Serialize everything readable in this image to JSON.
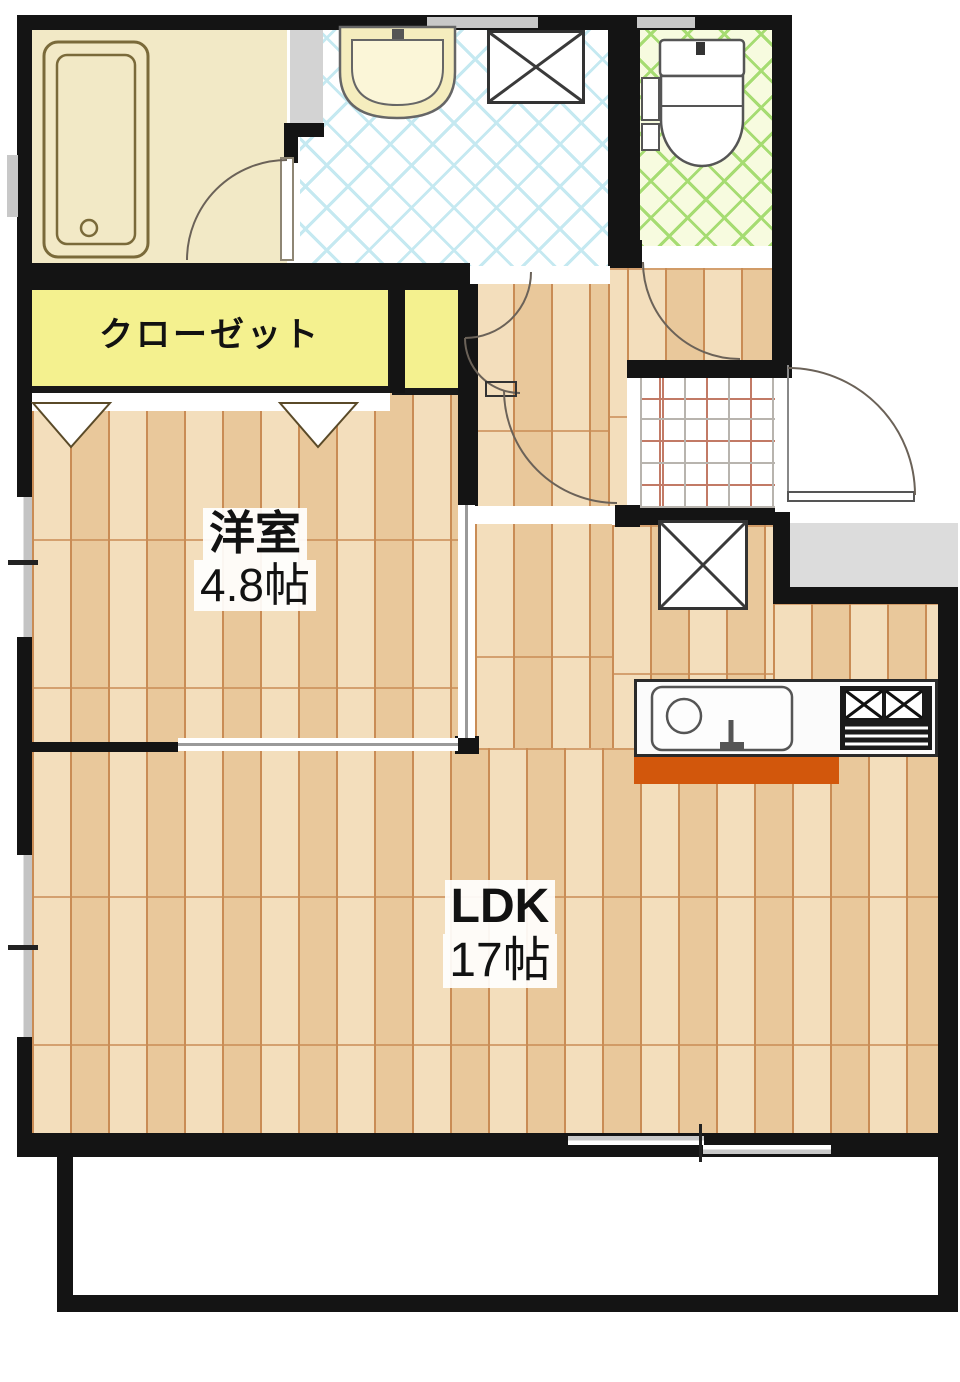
{
  "plan_title": "1LDK floor plan",
  "rooms": {
    "closet": {
      "label": "クローゼット"
    },
    "western_room": {
      "name": "洋室",
      "size": "4.8帖"
    },
    "ldk": {
      "name": "LDK",
      "size": "17帖"
    }
  },
  "fixtures": [
    "bathtub",
    "vanity-sink",
    "washing-machine-pan",
    "toilet",
    "refrigerator-space",
    "kitchen-sink",
    "gas-stove",
    "entry-door",
    "balcony"
  ],
  "colors": {
    "wall": "#141414",
    "wood_floor": "#E9C89B",
    "wood_line": "#C98C55",
    "bathroom": "#F2E9C6",
    "closet_yellow": "#F4F18F",
    "washroom_tile": "#C5E9F1",
    "toilet_tile": "#A6DC72",
    "entrance_grid_red": "#C27A66",
    "kitchen_base_orange": "#D2570C",
    "porch_gray": "#DCDCDC"
  }
}
